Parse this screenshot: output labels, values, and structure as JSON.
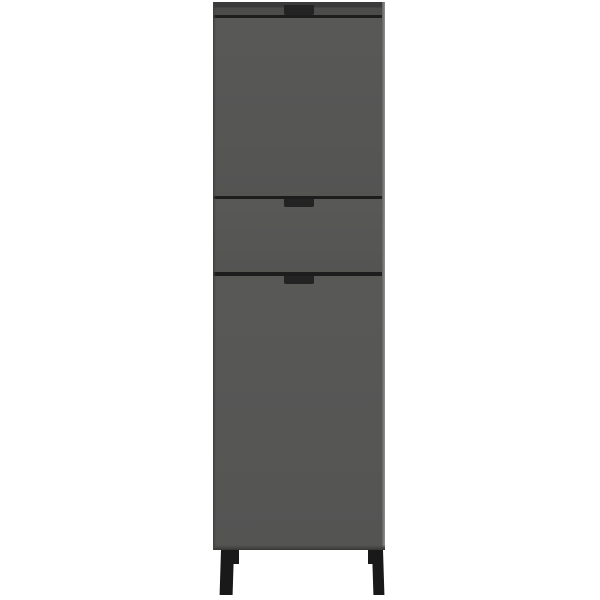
{
  "product": {
    "alt": "Tall anthracite grey cabinet with an upper door, a middle drawer and a lower door, each with a recessed black grip handle, standing on four black metal legs against a plain white background"
  },
  "parts": {
    "top_panel": "top panel",
    "upper_door": "upper door",
    "drawer": "drawer",
    "lower_door": "lower door",
    "handles": "recessed grip handles",
    "legs": "black metal legs"
  },
  "colors": {
    "background": "#ffffff",
    "body": "#565655",
    "top-panel": "#4c4c4b",
    "top-edge": "#3a3a3a",
    "gap-line": "#1d1d1d",
    "handle": "#232323",
    "leg": "#191919",
    "left-edge": "#3f3f3e",
    "right-edge-light": "#8f8f8d",
    "bottom-edge": "#454544"
  }
}
